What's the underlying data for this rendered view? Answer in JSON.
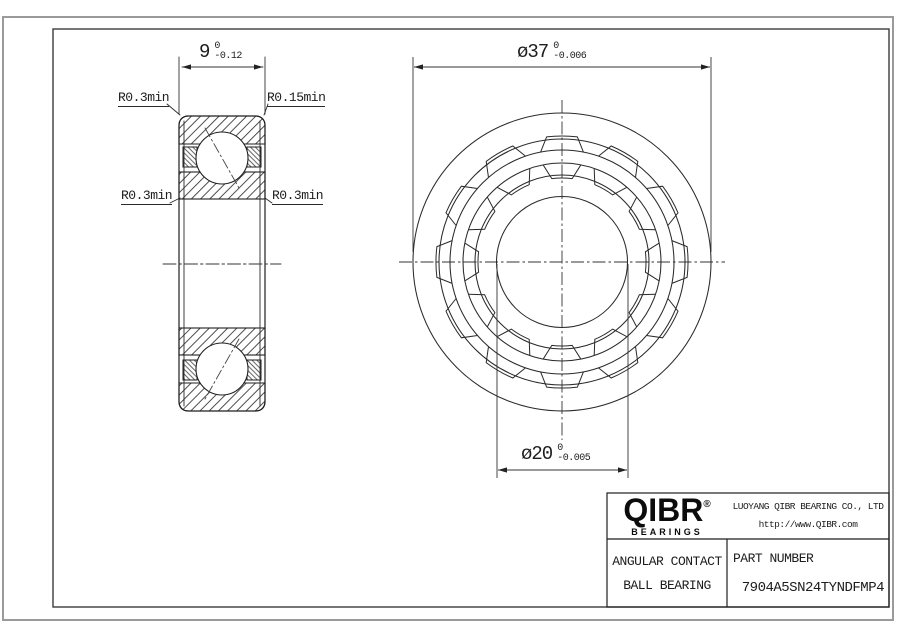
{
  "colors": {
    "ink": "#222222",
    "thin": "#333333",
    "frame": "#3c3c3c",
    "sheet_edge": "#9a9a9a",
    "background": "#ffffff"
  },
  "left_view": {
    "dim_width": {
      "value": "9",
      "tol_upper": "0",
      "tol_lower": "-0.12"
    },
    "labels": {
      "top_left": "R0.3min",
      "top_right": "R0.15min",
      "mid_left": "R0.3min",
      "mid_right": "R0.3min"
    }
  },
  "right_view": {
    "dim_od": {
      "symbol": "ø",
      "value": "37",
      "tol_upper": "0",
      "tol_lower": "-0.006"
    },
    "dim_bore": {
      "symbol": "ø",
      "value": "20",
      "tol_upper": "0",
      "tol_lower": "-0.005"
    }
  },
  "title_block": {
    "logo": {
      "text": "QIBR",
      "registered": "®",
      "sub": "BEARINGS"
    },
    "company": "LUOYANG QIBR BEARING CO., LTD",
    "website": "http://www.QIBR.com",
    "product_line1": "ANGULAR CONTACT",
    "product_line2": "BALL BEARING",
    "part_number_label": "PART NUMBER",
    "part_number": "7904A5SN24TYNDFMP4"
  }
}
